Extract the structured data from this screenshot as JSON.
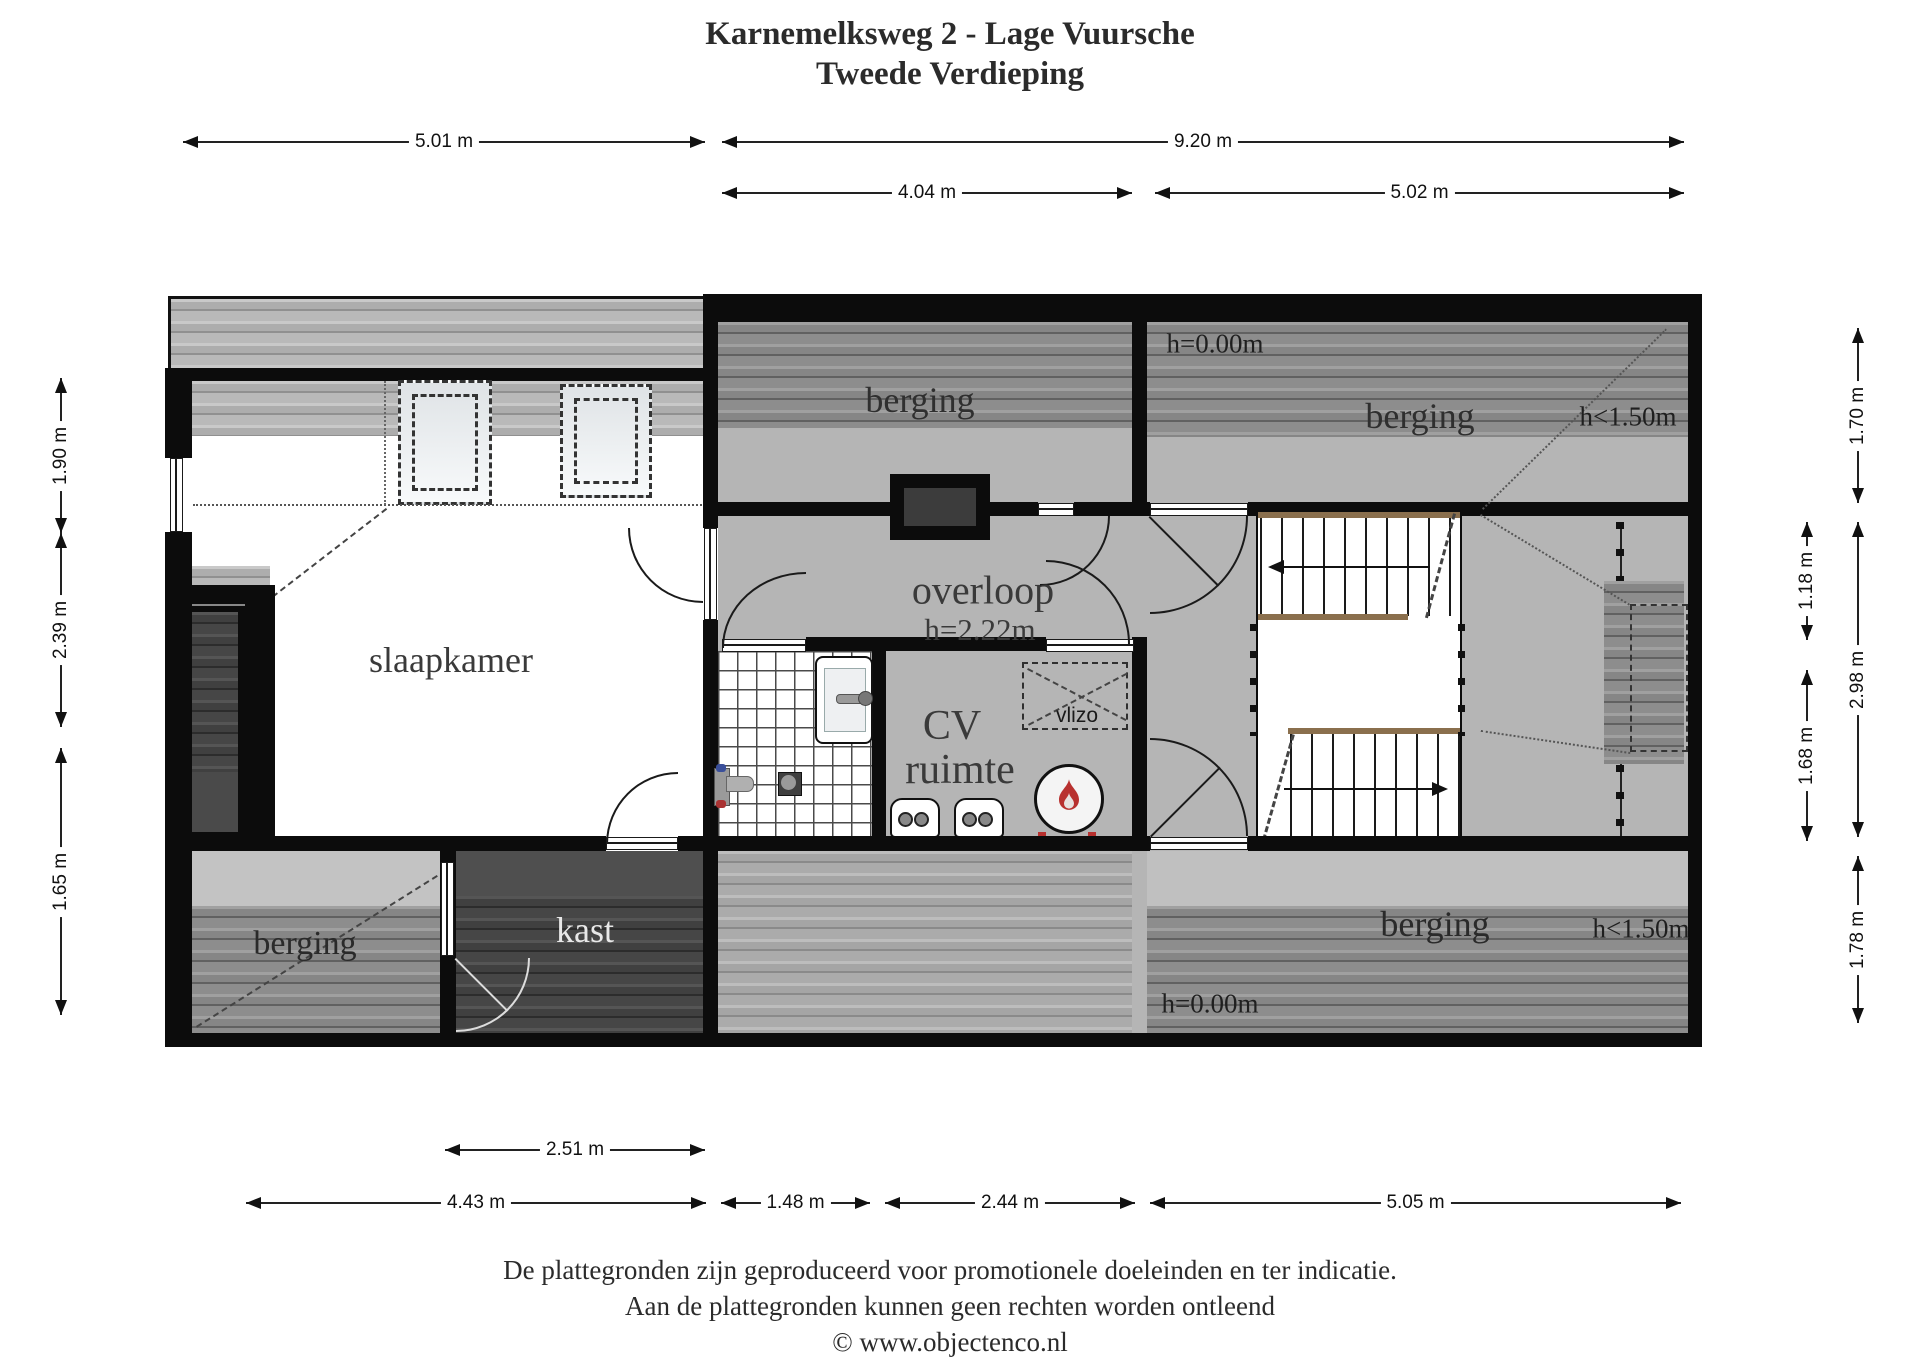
{
  "title": {
    "line1": "Karnemelksweg 2 - Lage Vuursche",
    "line2": "Tweede Verdieping"
  },
  "dims": {
    "t1": "5.01 m",
    "t2": "9.20 m",
    "t3": "4.04 m",
    "t4": "5.02 m",
    "l1": "1.90 m",
    "l2": "2.39 m",
    "l3": "1.65 m",
    "r1": "1.70 m",
    "r2": "2.98 m",
    "r3": "1.78 m",
    "ri1": "1.18 m",
    "ri2": "1.68 m",
    "b0": "2.51 m",
    "b1": "4.43 m",
    "b2": "1.48 m",
    "b3": "2.44 m",
    "b4": "5.05 m"
  },
  "rooms": {
    "slaapkamer": "slaapkamer",
    "berging_top_middle": "berging",
    "berging_top_right": "berging",
    "berging_bottom_left": "berging",
    "berging_bottom_right": "berging",
    "kast": "kast",
    "overloop": "overloop",
    "overloop_height": "h=2.22m",
    "cv_line1": "CV",
    "cv_line2": "ruimte",
    "vlizo": "vlizo"
  },
  "notes": {
    "h_zero_top": "h=0.00m",
    "h_150_top": "h<1.50m",
    "h_zero_bottom": "h=0.00m",
    "h_150_bottom": "h<1.50m"
  },
  "footer": {
    "line1": "De plattegronden zijn geproduceerd voor promotionele doeleinden en ter indicatie.",
    "line2": "Aan de plattegronden kunnen geen rechten worden ontleend",
    "line3": "© www.objectenco.nl"
  },
  "colors": {
    "wall": "#0c0c0c",
    "floor_grey": "#b5b5b5",
    "flame_red": "#b8312f"
  }
}
